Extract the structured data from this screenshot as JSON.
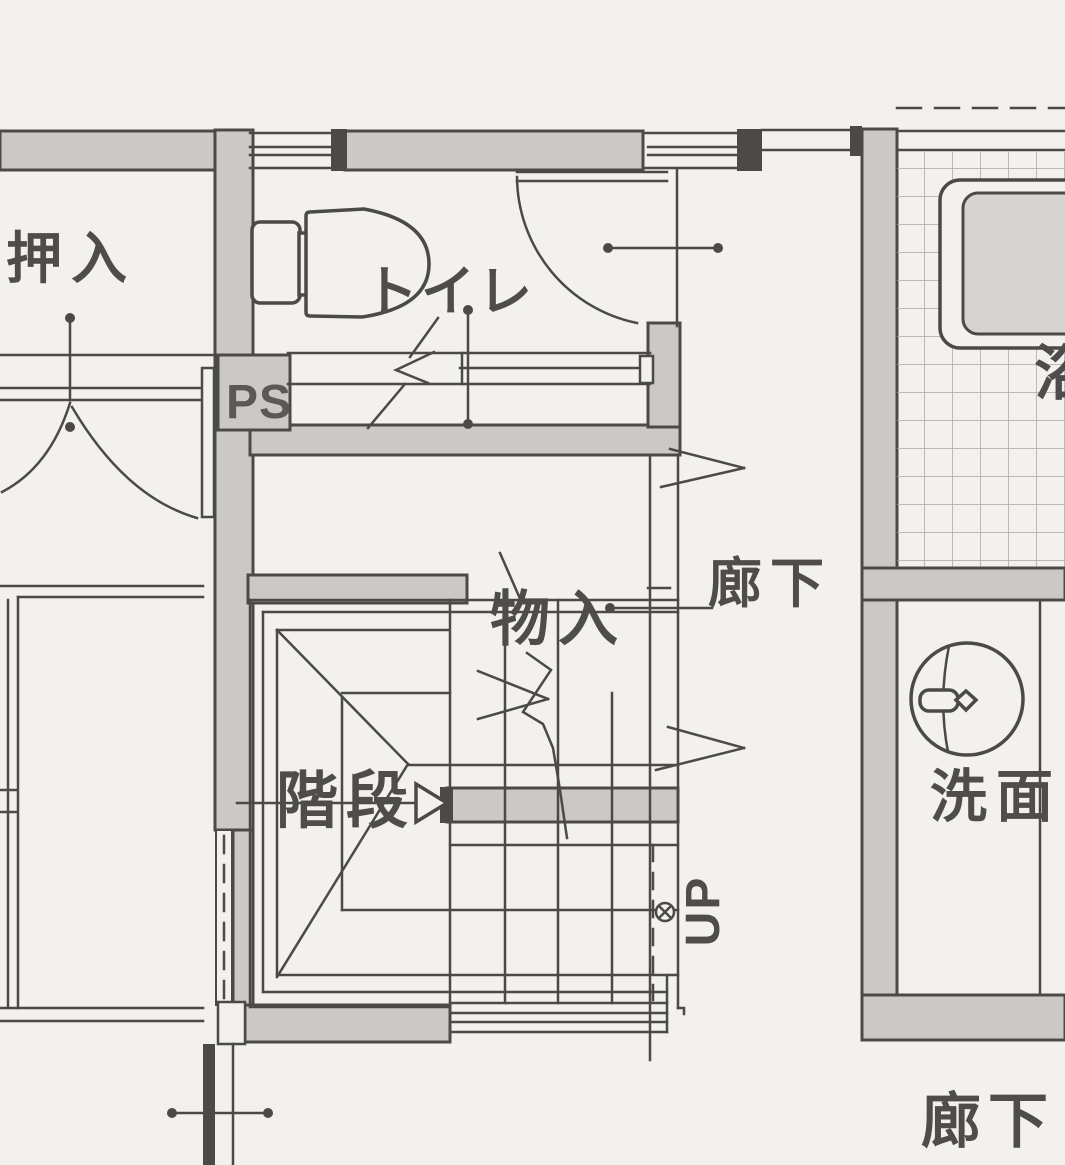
{
  "labels": {
    "closet": "押入",
    "toilet": "トイレ",
    "pipe_space": "PS",
    "storage": "物入",
    "hallway_middle": "廊下",
    "stairs": "階段",
    "up": "UP",
    "washroom": "洗面",
    "bath": "浴",
    "hallway_bottom": "廊下"
  },
  "colors": {
    "paper": "#f2f1ee",
    "wall_fill": "#cbc9c6",
    "line": "#4c4a47",
    "tub_fill": "#d6d4d1",
    "tile_line": "#a9a7a4",
    "text": "#4f4d4b",
    "ps_text": "#5b5955"
  }
}
